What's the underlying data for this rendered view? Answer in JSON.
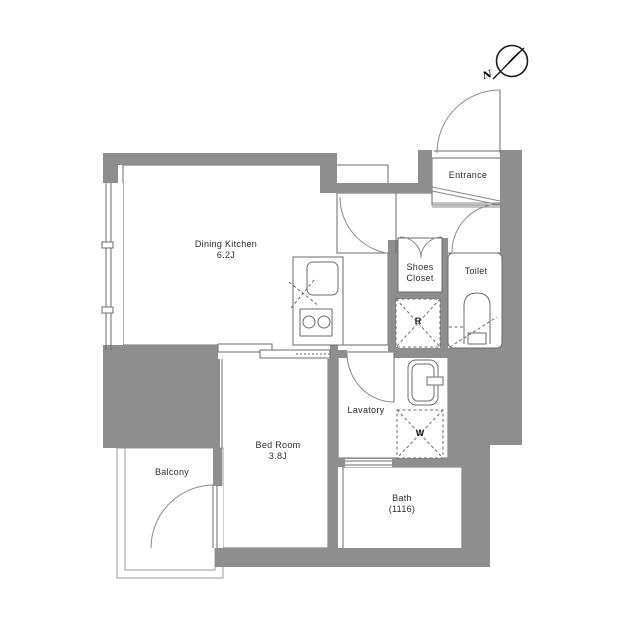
{
  "plan": {
    "compass": {
      "north_label": "N"
    },
    "rooms": {
      "dining_kitchen": {
        "name": "Dining Kitchen",
        "size": "6.2J"
      },
      "bed_room": {
        "name": "Bed Room",
        "size": "3.8J"
      },
      "balcony": {
        "name": "Balcony"
      },
      "entrance": {
        "name": "Entrance"
      },
      "shoes_closet": {
        "line1": "Shoes",
        "line2": "Closet"
      },
      "toilet": {
        "name": "Toilet"
      },
      "lavatory": {
        "name": "Lavatory"
      },
      "bath": {
        "name": "Bath",
        "size": "(1116)"
      }
    },
    "markers": {
      "refrigerator": "R",
      "washing_machine": "W"
    },
    "colors": {
      "wall": "#8e8e8e",
      "background": "#ffffff",
      "line": "#666666"
    }
  }
}
